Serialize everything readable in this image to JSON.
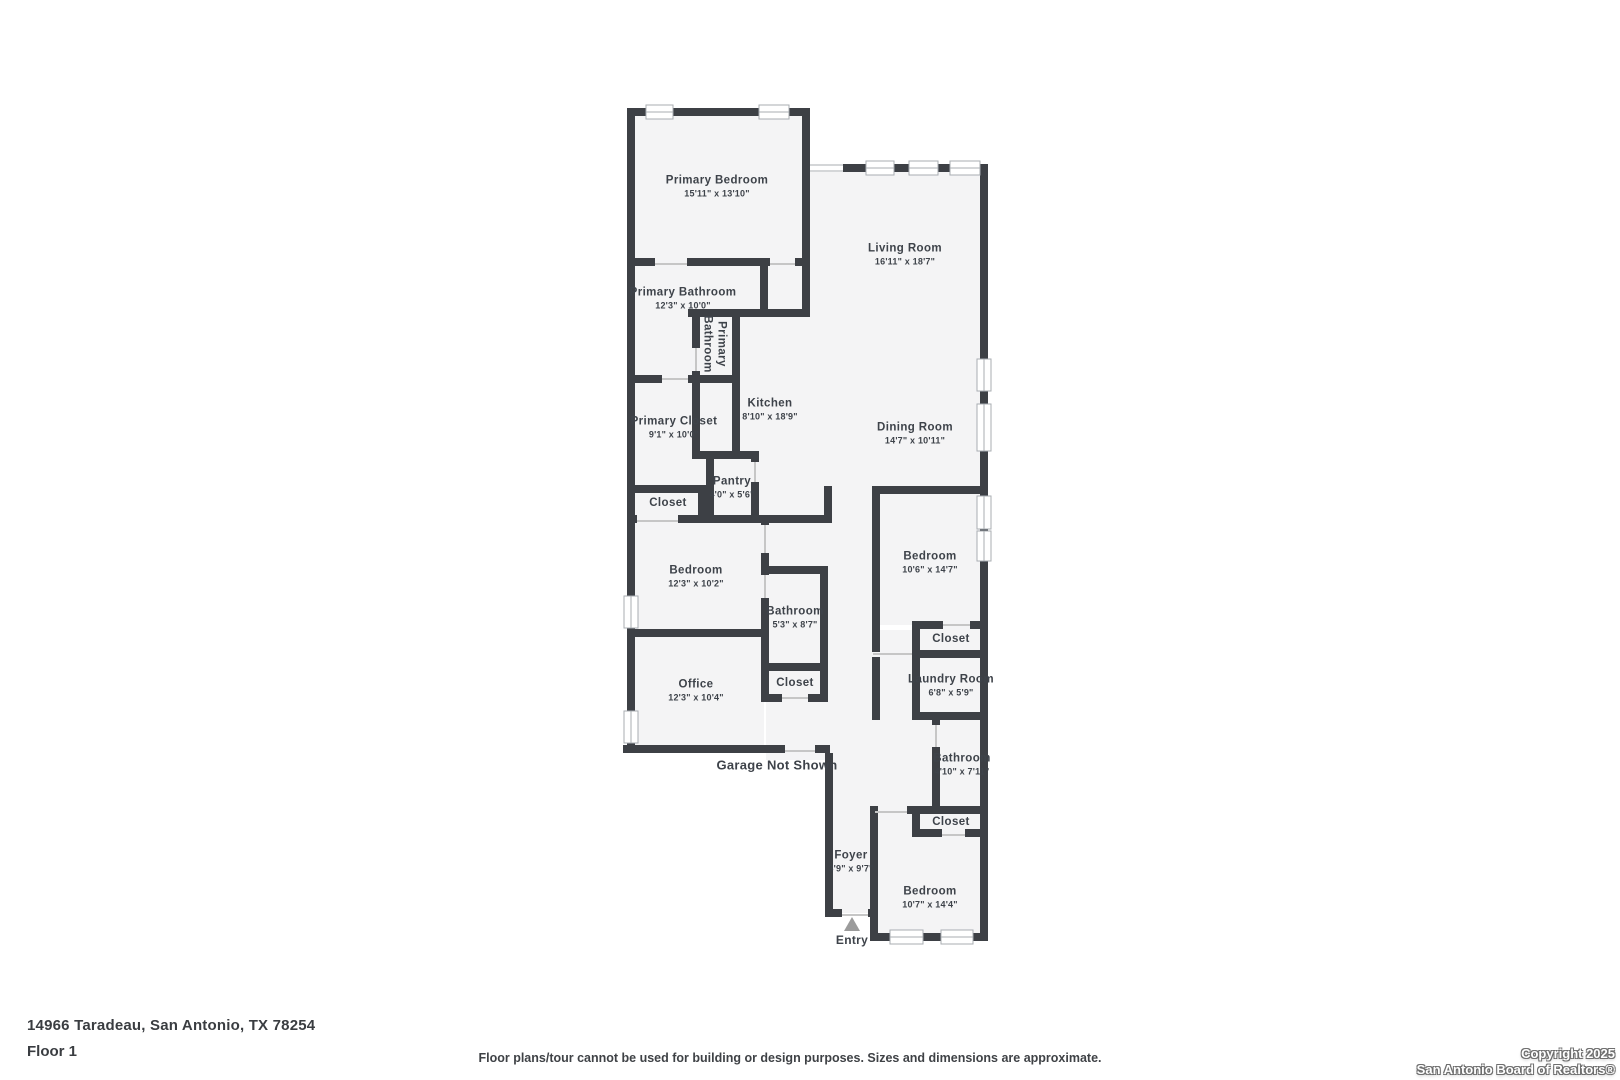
{
  "meta": {
    "address": "14966 Taradeau, San Antonio, TX 78254",
    "floor": "Floor 1",
    "disclaimer": "Floor plans/tour cannot be used for building or design purposes. Sizes and dimensions are approximate.",
    "copyright1": "Copyright 2025",
    "copyright2": "San Antonio Board of Realtors®"
  },
  "colors": {
    "wall": "#3d4045",
    "room_fill": "#f4f4f5",
    "label_text": "#3e434a",
    "window_frame": "#a8adb2",
    "entry_arrow": "#9b9b9b"
  },
  "floor_plan": {
    "rooms": [
      {
        "slug": "primary-bedroom",
        "name": "Primary Bedroom",
        "dims": "15'11\" x 13'10\"",
        "x": 717,
        "y": 187
      },
      {
        "slug": "living-room",
        "name": "Living Room",
        "dims": "16'11\" x 18'7\"",
        "x": 905,
        "y": 255
      },
      {
        "slug": "primary-bathroom",
        "name": "Primary Bathroom",
        "dims": "12'3\" x 10'0\"",
        "x": 683,
        "y": 299
      },
      {
        "slug": "primary-closet",
        "name": "Primary Closet",
        "dims": "9'1\" x 10'0\"",
        "x": 674,
        "y": 428
      },
      {
        "slug": "kitchen",
        "name": "Kitchen",
        "dims": "8'10\" x 18'9\"",
        "x": 770,
        "y": 410
      },
      {
        "slug": "dining-room",
        "name": "Dining Room",
        "dims": "14'7\" x 10'11\"",
        "x": 915,
        "y": 434
      },
      {
        "slug": "pantry",
        "name": "Pantry",
        "dims": "4'0\" x 5'6\"",
        "x": 732,
        "y": 488
      },
      {
        "slug": "closet-hall-upper",
        "name": "Closet",
        "dims": "",
        "x": 668,
        "y": 503
      },
      {
        "slug": "bedroom-west",
        "name": "Bedroom",
        "dims": "12'3\" x 10'2\"",
        "x": 696,
        "y": 577
      },
      {
        "slug": "bathroom-mid",
        "name": "Bathroom",
        "dims": "5'3\" x 8'7\"",
        "x": 795,
        "y": 618
      },
      {
        "slug": "closet-mid",
        "name": "Closet",
        "dims": "",
        "x": 795,
        "y": 683
      },
      {
        "slug": "office",
        "name": "Office",
        "dims": "12'3\" x 10'4\"",
        "x": 696,
        "y": 691
      },
      {
        "slug": "bedroom-east",
        "name": "Bedroom",
        "dims": "10'6\" x 14'7\"",
        "x": 930,
        "y": 563
      },
      {
        "slug": "closet-east",
        "name": "Closet",
        "dims": "",
        "x": 951,
        "y": 639
      },
      {
        "slug": "laundry-room",
        "name": "Laundry Room",
        "dims": "6'8\" x 5'9\"",
        "x": 951,
        "y": 686
      },
      {
        "slug": "bathroom-east",
        "name": "Bathroom",
        "dims": "4'10\" x 7'11\"",
        "x": 962,
        "y": 765
      },
      {
        "slug": "closet-south",
        "name": "Closet",
        "dims": "",
        "x": 951,
        "y": 822
      },
      {
        "slug": "foyer",
        "name": "Foyer",
        "dims": "3'9\" x 9'7\"",
        "x": 851,
        "y": 862
      },
      {
        "slug": "bedroom-south",
        "name": "Bedroom",
        "dims": "10'7\" x 14'4\"",
        "x": 930,
        "y": 898
      }
    ],
    "rotated_label": {
      "slug": "primary-bathroom-wc",
      "lines": [
        "Primary",
        "Bathroom"
      ],
      "x": 714,
      "y": 344
    },
    "plain_labels": [
      {
        "slug": "garage-note",
        "text": "Garage Not Shown",
        "x": 777,
        "y": 765,
        "cls": "garage-label"
      },
      {
        "slug": "entry",
        "text": "Entry",
        "x": 852,
        "y": 940,
        "cls": "entry-label"
      }
    ]
  }
}
